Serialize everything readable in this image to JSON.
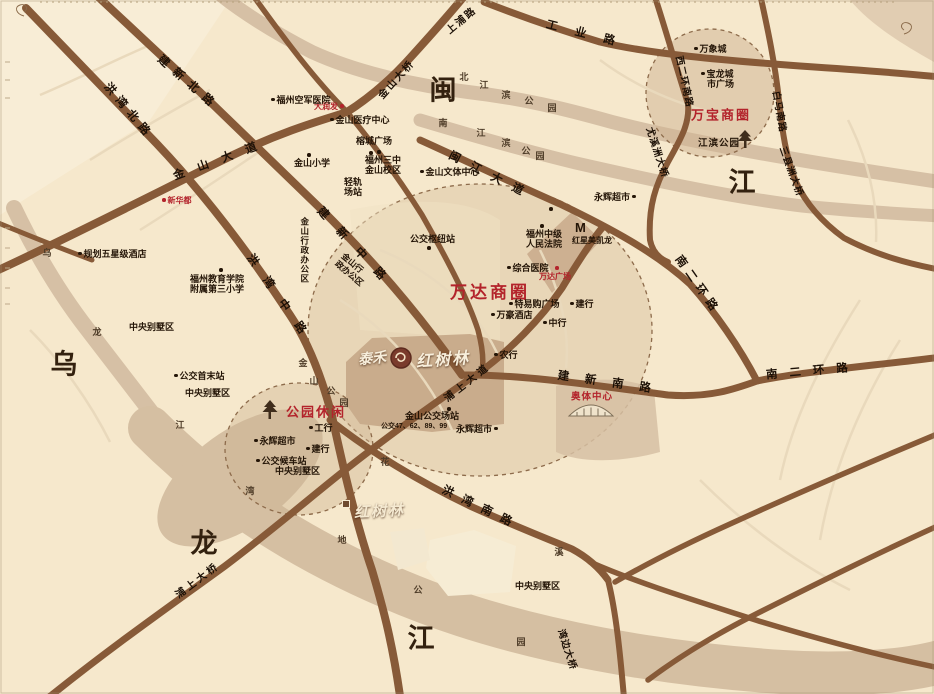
{
  "map_title": "泰禾红树林区位图",
  "logos": {
    "brand": "泰禾",
    "project": "红树林",
    "site_marker": "红树林"
  },
  "red_areas": [
    "万达商圈",
    "万宝商圈",
    "公园休闲",
    "奥体中心"
  ],
  "red_pois": [
    "新华都",
    "大润发",
    "万达广场"
  ],
  "roads": [
    "建新北路",
    "洪湾北路",
    "金山大道",
    "金山大桥",
    "上浦路",
    "工业路",
    "西二环南路",
    "白马南路",
    "尤溪洲大桥",
    "三县洲大桥",
    "闽江大道",
    "建新中路",
    "洪湾中路",
    "建新南路",
    "南二环路",
    "南二环路",
    "浦上大桥",
    "湾边大桥",
    "洪湾南路",
    "浦上大道"
  ],
  "big_chars": [
    "闽",
    "江",
    "乌",
    "龙",
    "江"
  ],
  "bank": {
    "north": [
      "北",
      "江",
      "滨",
      "公",
      "园"
    ],
    "south": [
      "南",
      "江",
      "滨",
      "公",
      "园"
    ],
    "jinshan": [
      "金",
      "山",
      "公",
      "园"
    ],
    "scatter": [
      "花",
      "溪",
      "地",
      "公",
      "园",
      "湾",
      "江",
      "龙",
      "乌"
    ]
  },
  "pois": [
    "规划五星级酒店",
    "福州空军医院",
    "金山医疗中心",
    "榕城广场",
    "金山小学",
    {
      "l1": "福州三中",
      "l2": "金山校区"
    },
    {
      "l1": "轻轨",
      "l2": "场站"
    },
    "金山文体中心",
    "公交枢纽站",
    "金山行政办公区",
    {
      "l1": "金山行",
      "l2": "政办公区"
    },
    {
      "l1": "福州教育学院",
      "l2": "附属第三小学"
    },
    "中央别墅区",
    "中央别墅区",
    "中央别墅区",
    "中央别墅区",
    "公交首末站",
    {
      "l1": "福州中级",
      "l2": "人民法院"
    },
    "M",
    "红星美凯龙",
    "综合医院",
    "特易购广场",
    "万豪酒店",
    "建行",
    "中行",
    "农行",
    "永辉超市",
    "永辉超市",
    "永辉超市",
    "金山公交场站",
    "公交47、62、89、99",
    "工行",
    "建行",
    "公交候车站",
    "万象城",
    {
      "l1": "宝龙城",
      "l2": "市广场"
    },
    "江滨公园"
  ],
  "colors": {
    "background": "#f6e8cc",
    "river": "#d6c0a5",
    "road": "#875a38",
    "accent_red": "#b3232b",
    "block": "#cdb091",
    "text": "#241507"
  }
}
